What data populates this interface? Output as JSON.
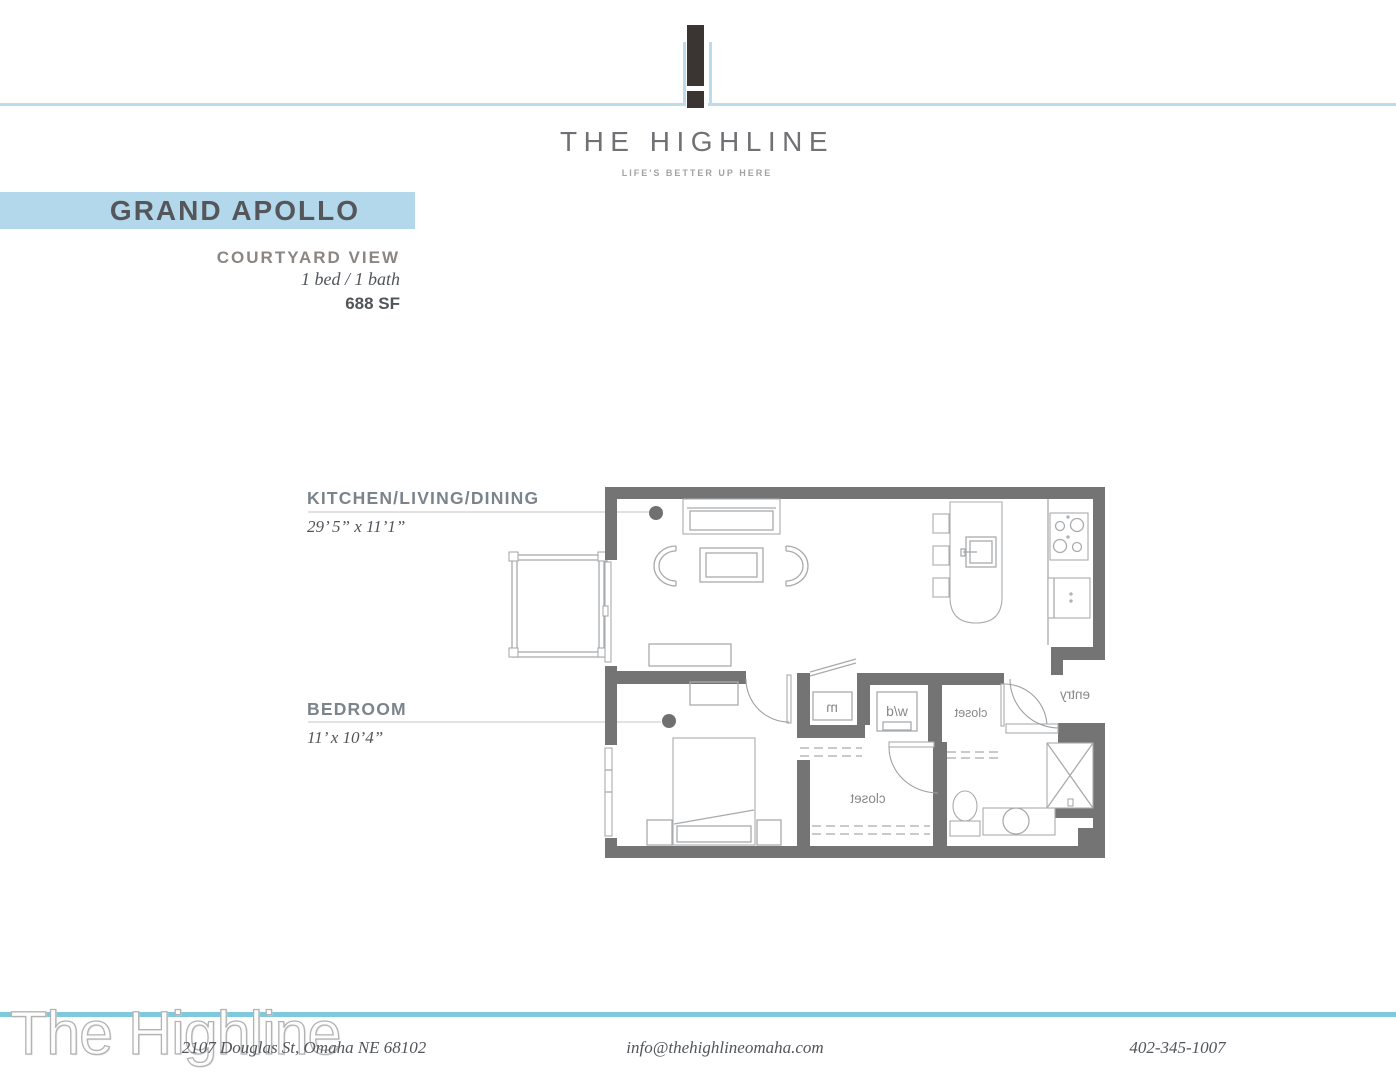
{
  "colors": {
    "line_blue": "#bcdcee",
    "band_blue": "#b3d8ec",
    "footer_blue": "#7ec9dd",
    "logo_dark": "#3a3532",
    "wall_gray": "#757474",
    "furniture_gray": "#a8abad",
    "slate_label": "#7b838b",
    "warm_label": "#8b8682",
    "ink": "#515459",
    "ink_dark": "#55565a",
    "brand_gray": "#707174",
    "tagline_gray": "#a2a3a5",
    "leader_dot": "#6e7072",
    "plan_text": "#87898b",
    "watermark_gray": "#b3b3b3"
  },
  "header": {
    "brand": "THE HIGHLINE",
    "tagline": "LIFE'S BETTER UP HERE"
  },
  "unit": {
    "name": "GRAND APOLLO",
    "view": "COURTYARD VIEW",
    "config": "1 bed / 1 bath",
    "area": "688 SF"
  },
  "rooms": {
    "kitchen_living_dining": {
      "label": "KITCHEN/LIVING/DINING",
      "dimensions": "29’ 5” x 11’1”"
    },
    "bedroom": {
      "label": "BEDROOM",
      "dimensions": "11’ x 10’4”"
    }
  },
  "floorplan_labels": {
    "mechanical": "m",
    "washer_dryer": "w/d",
    "hall_closet": "closet",
    "walkin_closet": "closet",
    "entry": "entry"
  },
  "footer": {
    "watermark": "The Highline",
    "address": "2107 Douglas St, Omaha NE 68102",
    "email": "info@thehighlineomaha.com",
    "phone": "402-345-1007"
  }
}
